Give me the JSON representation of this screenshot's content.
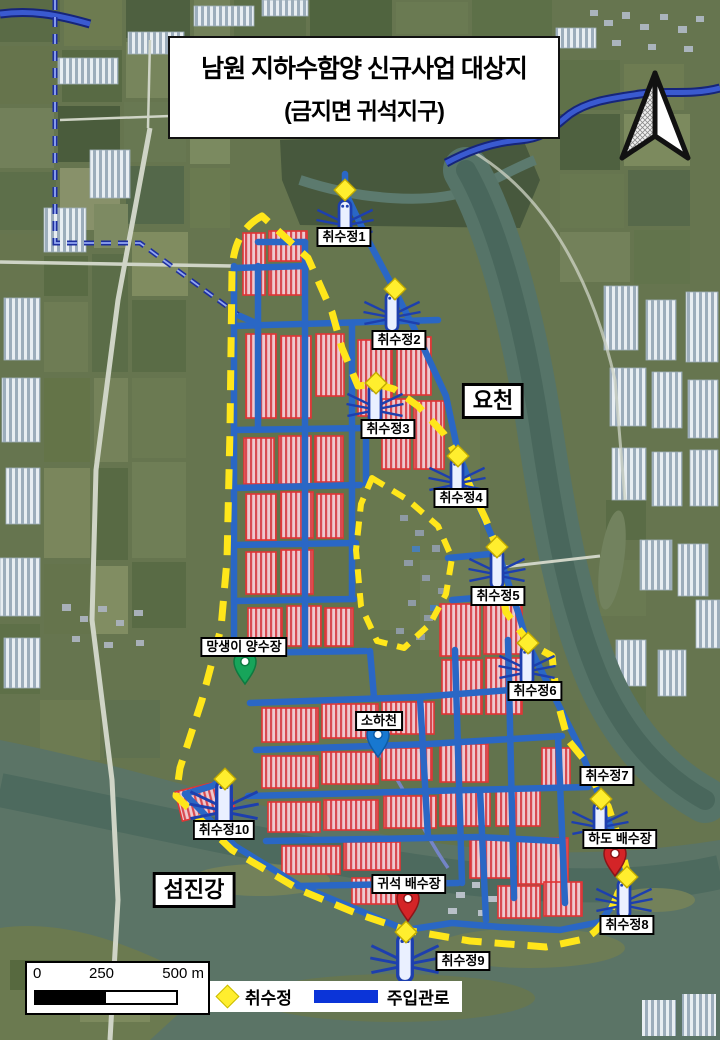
{
  "title": {
    "line1": "남원 지하수함양 신규사업 대상지",
    "line2": "(금지면 귀석지구)"
  },
  "map": {
    "region_labels": [
      {
        "id": "yocheon",
        "text": "요천"
      },
      {
        "id": "seomjingang",
        "text": "섬진강"
      }
    ],
    "wells": [
      {
        "label": "취수정1"
      },
      {
        "label": "취수정2"
      },
      {
        "label": "취수정3"
      },
      {
        "label": "취수정4"
      },
      {
        "label": "취수정5"
      },
      {
        "label": "취수정6"
      },
      {
        "label": "취수정7"
      },
      {
        "label": "취수정8"
      },
      {
        "label": "취수정9"
      },
      {
        "label": "취수정10"
      }
    ],
    "facilities": [
      {
        "id": "mangsaengi-pumping-station",
        "label": "망생이 양수장",
        "pin_color": "#17a45a"
      },
      {
        "id": "sohacheon-stream",
        "label": "소하천",
        "pin_color": "#1878d0"
      },
      {
        "id": "hado-drainage",
        "label": "하도 배수장",
        "pin_color": "#d42427"
      },
      {
        "id": "gwiseok-drainage",
        "label": "귀석 배수장",
        "pin_color": "#d42427"
      }
    ]
  },
  "legend": {
    "items": [
      {
        "symbol": "diamond",
        "label": "취수정",
        "color": "#ffee2e"
      },
      {
        "symbol": "line",
        "label": "주입관로",
        "color": "#0b34d8"
      }
    ]
  },
  "scale_bar": {
    "ticks": [
      "0",
      "250",
      "500 m"
    ]
  },
  "colors": {
    "boundary_dash": "#ffe61a",
    "injection_pipe": "#2a67c5",
    "supply_line": "#1d2f9f",
    "well_diamond": "#ffee2e"
  }
}
